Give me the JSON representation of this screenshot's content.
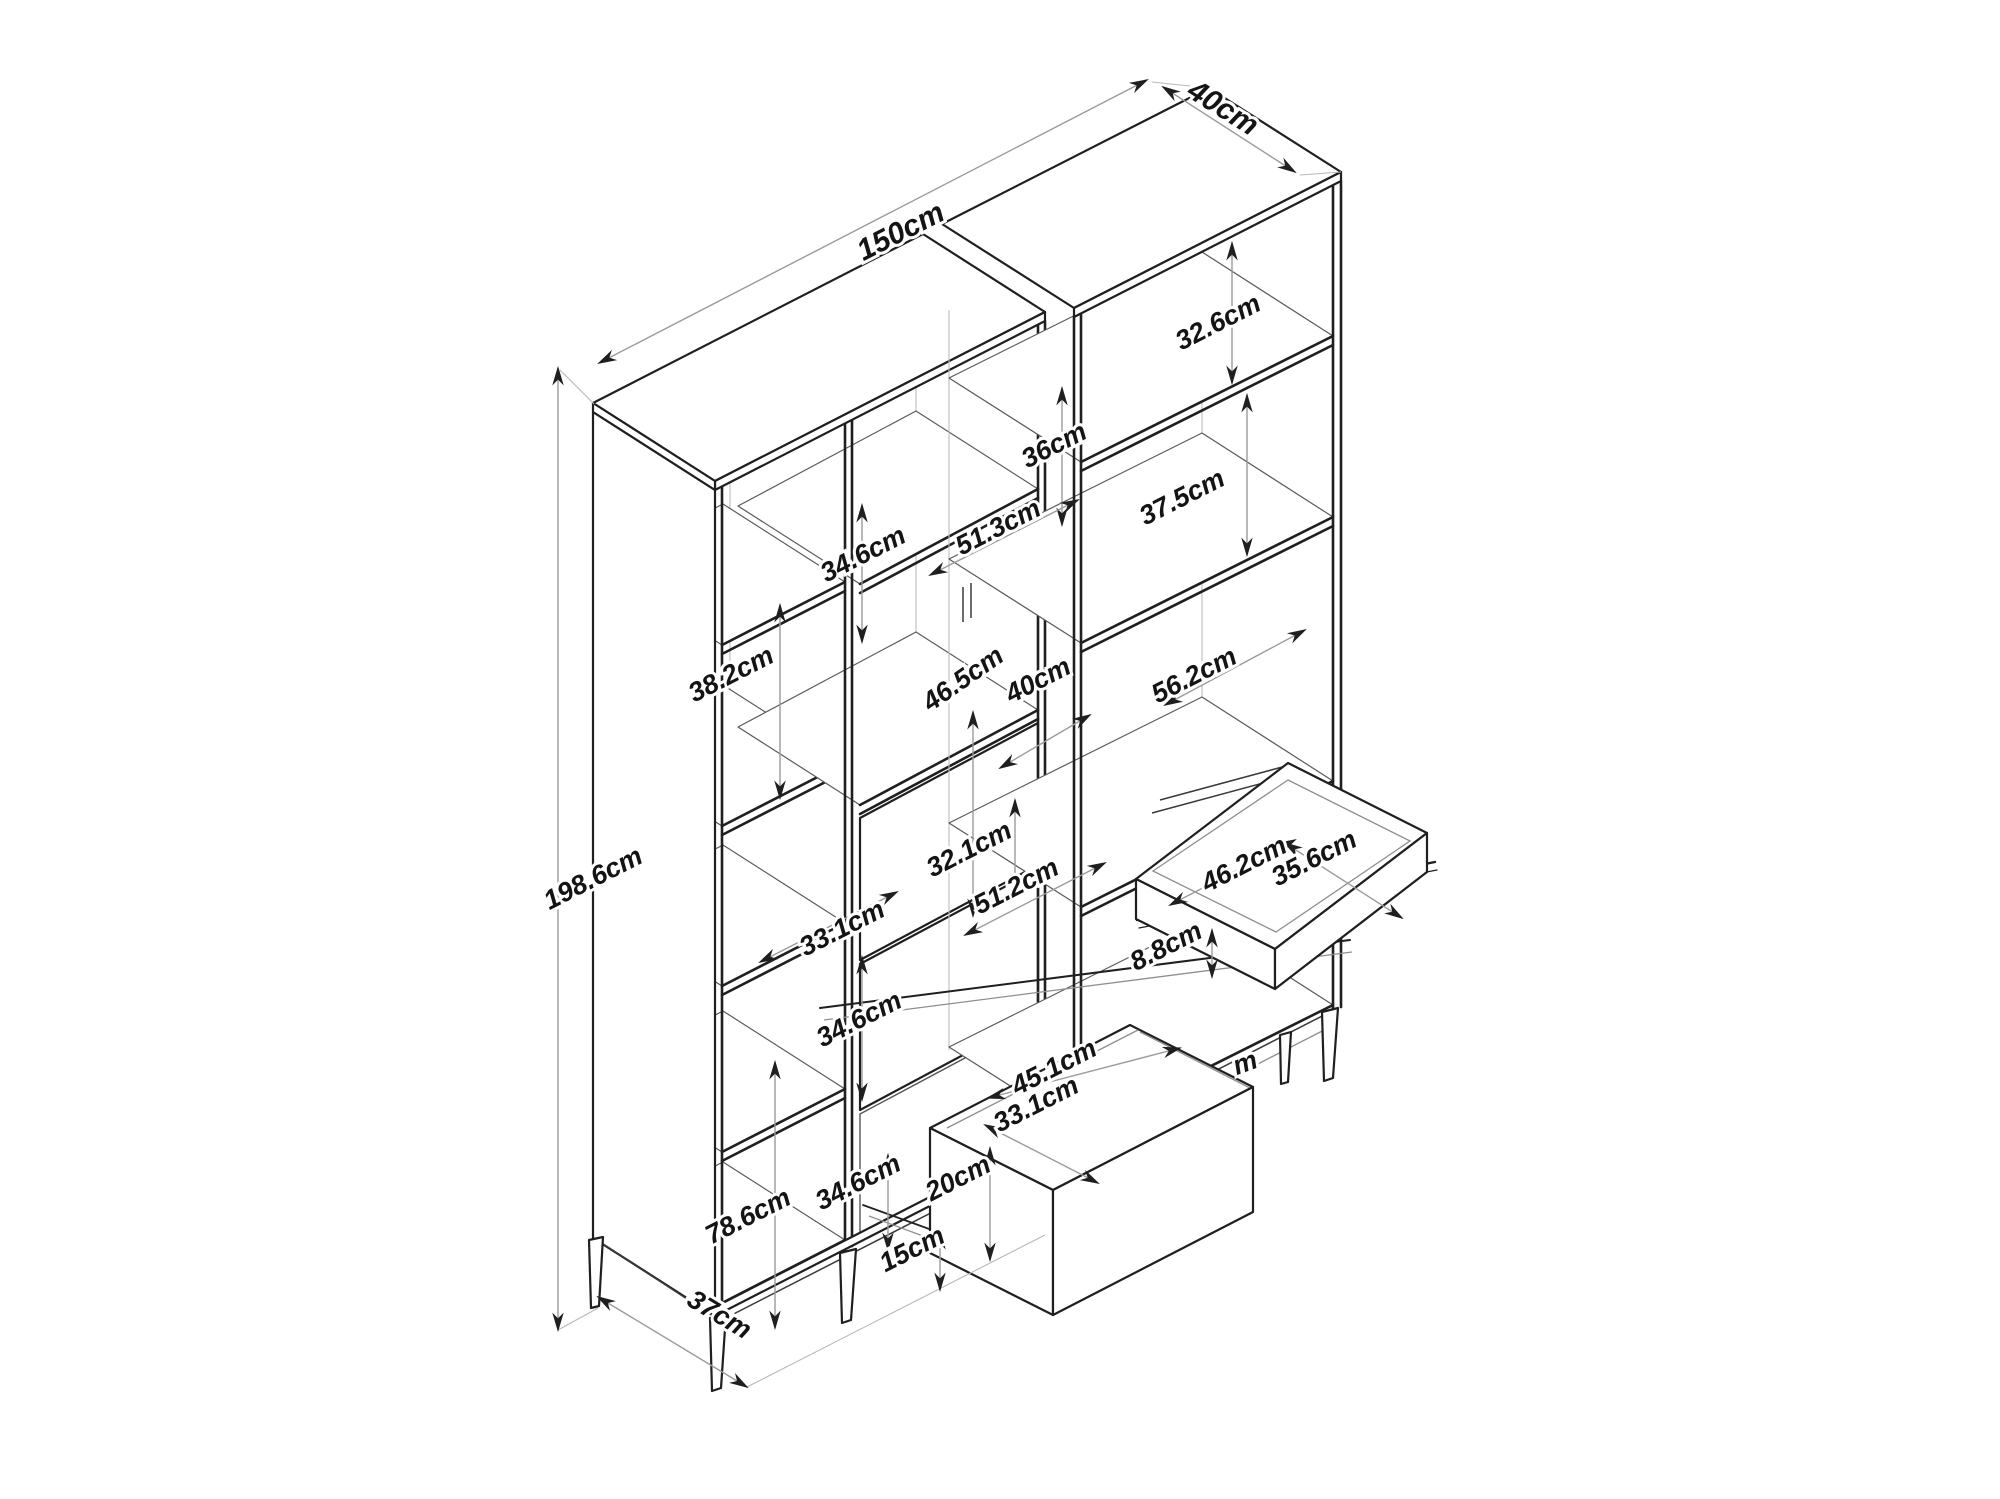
{
  "drawing": {
    "kind": "isometric-furniture-dimension-diagram",
    "subject": "bookcase cabinet with open shelves, pull-out tray and pull-out drawer",
    "unit": "cm",
    "background_color": "#ffffff",
    "structure_line_color": "#1f1f1f",
    "dimension_line_color": "#9b9b9b",
    "label_text_color": "#141414"
  },
  "dims": [
    {
      "name": "overall-width",
      "text": "150cm"
    },
    {
      "name": "top-depth",
      "text": "40cm"
    },
    {
      "name": "right-compartment-1",
      "text": "32.6cm"
    },
    {
      "name": "right-compartment-2",
      "text": "37.5cm"
    },
    {
      "name": "left-compartment-1",
      "text": "34.6cm"
    },
    {
      "name": "middle-shelf-width",
      "text": "51.3cm"
    },
    {
      "name": "middle-compartment-top",
      "text": "36cm"
    },
    {
      "name": "middle-open-height",
      "text": "46.5cm"
    },
    {
      "name": "middle-shelf-depth",
      "text": "40cm"
    },
    {
      "name": "right-shelf-width",
      "text": "56.2cm"
    },
    {
      "name": "left-compartment-2",
      "text": "38.2cm"
    },
    {
      "name": "middle-drawer-height",
      "text": "32.1cm"
    },
    {
      "name": "middle-drawer-width",
      "text": "51.2cm"
    },
    {
      "name": "left-compartment-width",
      "text": "33.1cm"
    },
    {
      "name": "left-compartment-4",
      "text": "34.6cm"
    },
    {
      "name": "left-compartment-5",
      "text": "34.6cm"
    },
    {
      "name": "tray-width",
      "text": "46.2cm"
    },
    {
      "name": "tray-depth",
      "text": "35.6cm"
    },
    {
      "name": "tray-height",
      "text": "8.8cm"
    },
    {
      "name": "drawer-width",
      "text": "45.1cm"
    },
    {
      "name": "drawer-depth",
      "text": "33.1cm"
    },
    {
      "name": "drawer-front-height",
      "text": "20cm"
    },
    {
      "name": "leg-height",
      "text": "15cm"
    },
    {
      "name": "lower-section-height",
      "text": "78.6cm"
    },
    {
      "name": "base-depth",
      "text": "37cm"
    },
    {
      "name": "overall-height",
      "text": "198.6cm"
    },
    {
      "name": "partial-label",
      "text": "m"
    }
  ]
}
